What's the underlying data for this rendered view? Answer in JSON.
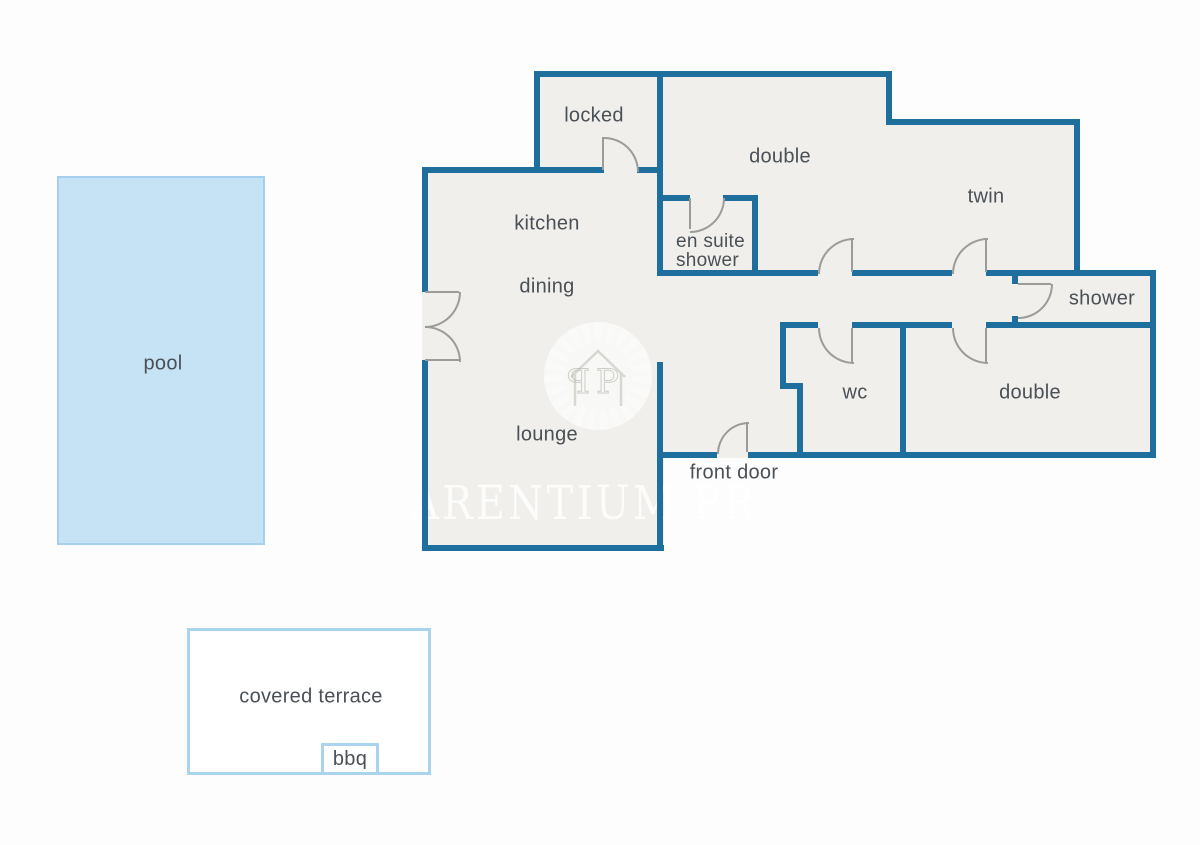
{
  "rooms": {
    "locked": "locked",
    "double_top": "double",
    "twin": "twin",
    "kitchen": "kitchen",
    "ensuite_line1": "en suite",
    "ensuite_line2": "shower",
    "dining": "dining",
    "shower": "shower",
    "wc": "wc",
    "lounge": "lounge",
    "double_bottom": "double"
  },
  "labels": {
    "front_door": "front door"
  },
  "outdoor": {
    "pool": "pool",
    "covered_terrace": "covered terrace",
    "bbq": "bbq"
  },
  "watermark": {
    "text": "ARENTIUM PR",
    "monogram_left": "P",
    "monogram_right": "P"
  },
  "colors": {
    "wall": "#1e6e9e",
    "floor": "#f0efec",
    "door": "#9b9b99",
    "label_text": "#4a5056",
    "pool_fill": "#c6e2f5",
    "pool_border": "#a5cfec",
    "terrace_border": "#a9d3ee",
    "background": "#fdfdfd",
    "watermark": "#ffffff"
  }
}
